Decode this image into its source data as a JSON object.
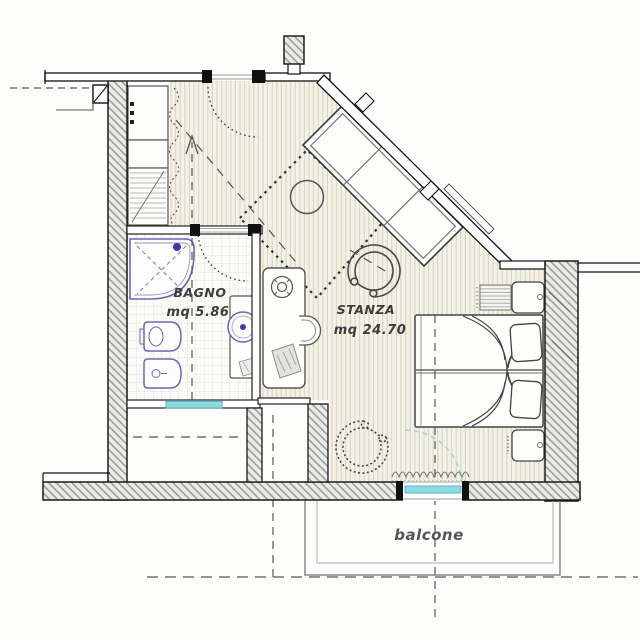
{
  "plan_title": "hotel-room-floor-plan",
  "rooms": {
    "bagno": {
      "label": "BAGNO",
      "area": "mq 5.86"
    },
    "stanza": {
      "label": "STANZA",
      "area": "mq 24.70"
    },
    "balcone": {
      "label": "balcone"
    }
  },
  "fixture_icons": [
    "corner-shower-icon",
    "toilet-icon",
    "bidet-icon",
    "vanity-sink-icon",
    "wardrobe-icon",
    "open-closet-curtain-icon",
    "desk-icon",
    "desk-chair-icon",
    "tub-armchair-icon",
    "tub-armchair-dotted-icon",
    "round-table-icon",
    "double-bed-icon",
    "pillow-icon",
    "nightstand-icon",
    "radiator-icon",
    "diagonal-window-icon",
    "door-swing-arc-icon",
    "balcony-door-glazing-icon",
    "curtain-squiggle-icon",
    "direction-arrow-icon",
    "column-icon",
    "chimney-pillar-icon"
  ],
  "colors": {
    "floor_stripes_bg": "#f4f1e5",
    "floor_stripe_line": "#d8d5c6",
    "tile_bg": "#fbfbf7",
    "tile_line": "#dddcd5",
    "wall_hatch_bg": "#ebebe8",
    "wall_hatch_line": "#999999",
    "wall_edge": "#1a1a1a",
    "fixture_purple": "#6f66b8",
    "fixture_dot_blue": "#4038a8",
    "glazing_cyan": "#8fd9e2",
    "glazing_cyan_line": "#49b6c6",
    "swing_arc_blue": "#a8d4e6",
    "dash_line": "#555555",
    "furniture_stroke": "#4a4a4a"
  }
}
